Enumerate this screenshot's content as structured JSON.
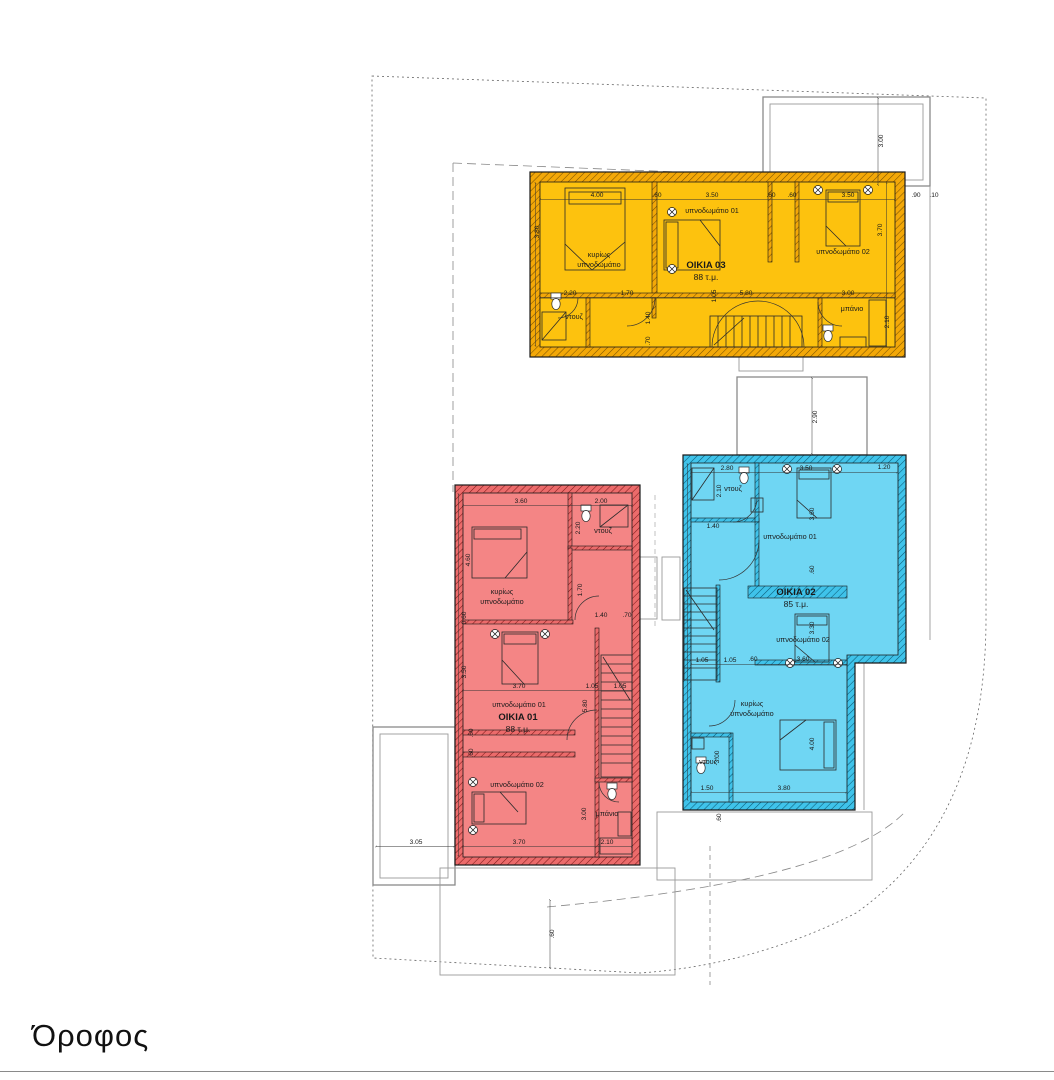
{
  "title": "Όροφος",
  "houses": {
    "h3": {
      "name": "OIKIA 03",
      "area": "88 τ.μ.",
      "rooms": {
        "master1": "κυρίως",
        "master2": "υπνοδωμάτιο",
        "bed1": "υπνοδωμάτιο 01",
        "bed2": "υπνοδωμάτιο 02",
        "shower": "ντουζ",
        "bath": "μπάνιο"
      },
      "dims": {
        "t1": "4.00",
        "t2": ".60",
        "t3": "3.50",
        "t4": ".60",
        "t5": ".60",
        "t6": "3.50",
        "ro1": ".90",
        "ro2": ".10",
        "lv": "3.80",
        "rv": "3.70",
        "m1": "2.20",
        "m2": "1.70",
        "m3": "5.80",
        "m4": "3.00",
        "v1": "1.05",
        "v2": "1.40",
        "v3": ".70",
        "bathv": "2.10"
      }
    },
    "h1": {
      "name": "OIKIA 01",
      "area": "88 τ.μ.",
      "rooms": {
        "master1": "κυρίως",
        "master2": "υπνοδωμάτιο",
        "bed1": "υπνοδωμάτιο 01",
        "bed2": "υπνοδωμάτιο 02",
        "shower": "ντουζ",
        "bath": "μπάνιο"
      },
      "dims": {
        "t1": "3.60",
        "t2": "2.00",
        "sv": "2.20",
        "hv": "1.70",
        "w1": "0.60",
        "lv": "3.50",
        "w2": ".60",
        "w3": ".60",
        "mv": "4.60",
        "stv": "5.80",
        "m1": "1.40",
        "m2": ".70",
        "c1": "3.70",
        "c2": "1.05",
        "c3": "1.05",
        "bv": "3.00",
        "b1": "3.70",
        "b2": "2.10"
      }
    },
    "h2": {
      "name": "OIKIA 02",
      "area": "85 τ.μ.",
      "rooms": {
        "master1": "κυρίως",
        "master2": "υπνοδωμάτιο",
        "bed1": "υπνοδωμάτιο 01",
        "bed2": "υπνοδωμάτιο 02",
        "shower1": "ντουζ",
        "shower2": "ντουζ"
      },
      "dims": {
        "t1": "2.80",
        "t2": "3.50",
        "t3": "1.20",
        "sv": "2.10",
        "m1": "1.40",
        "b1v": "3.60",
        "w1": ".60",
        "b2v": "3.30",
        "c1": "1.05",
        "c2": "1.05",
        "c3": ".60",
        "c4": "3.60",
        "mv": "4.00",
        "s2v": "3.00",
        "bo1": "1.50",
        "bo2": "3.80",
        "w2": ".60"
      }
    }
  },
  "site": {
    "balcony_top": "3.00",
    "balcony_mid": "2.90",
    "terrace_left": "3.05",
    "deck_off": ".60"
  }
}
